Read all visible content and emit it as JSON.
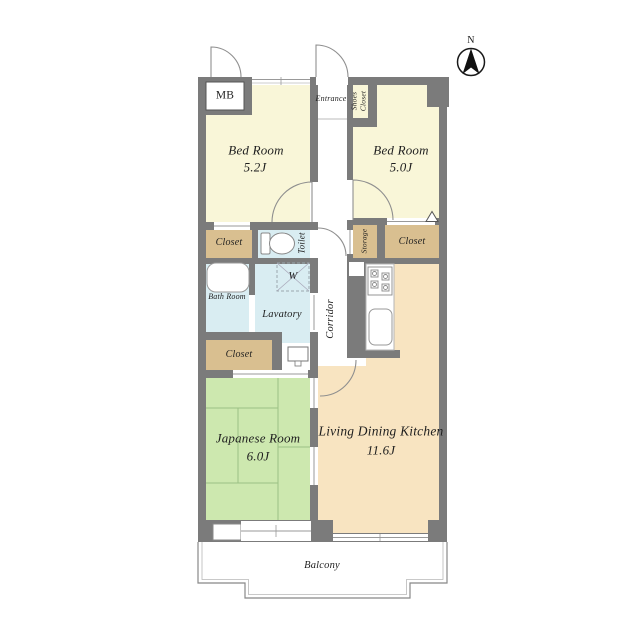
{
  "plan": {
    "compass_label": "N"
  },
  "rooms": {
    "bedroom1": {
      "name": "Bed Room",
      "area": "5.2J"
    },
    "bedroom2": {
      "name": "Bed Room",
      "area": "5.0J"
    },
    "japanese_room": {
      "name": "Japanese Room",
      "area": "6.0J"
    },
    "ldk": {
      "name": "Living Dining Kitchen",
      "area": "11.6J"
    },
    "entrance": {
      "name": "Entrance"
    },
    "shoes_closet": {
      "name": "Shoes Closet"
    },
    "meter_box": {
      "name": "MB"
    },
    "closet_bedroom1": {
      "name": "Closet"
    },
    "toilet": {
      "name": "Toilet"
    },
    "storage": {
      "name": "Storage"
    },
    "closet_bedroom2": {
      "name": "Closet"
    },
    "bath_room": {
      "name": "Bath Room"
    },
    "washing_machine": {
      "name": "W"
    },
    "lavatory": {
      "name": "Lavatory"
    },
    "corridor": {
      "name": "Corridor"
    },
    "closet_japanese_room": {
      "name": "Closet"
    },
    "balcony": {
      "name": "Balcony"
    }
  },
  "colors": {
    "wall": "#7b7b7b",
    "bedroom_fill": "#f9f6d8",
    "ldk_fill": "#f8e4c1",
    "closet_fill": "#d9bf90",
    "wet_area_fill": "#d9edf2",
    "japanese_room_fill": "#cde8af"
  }
}
